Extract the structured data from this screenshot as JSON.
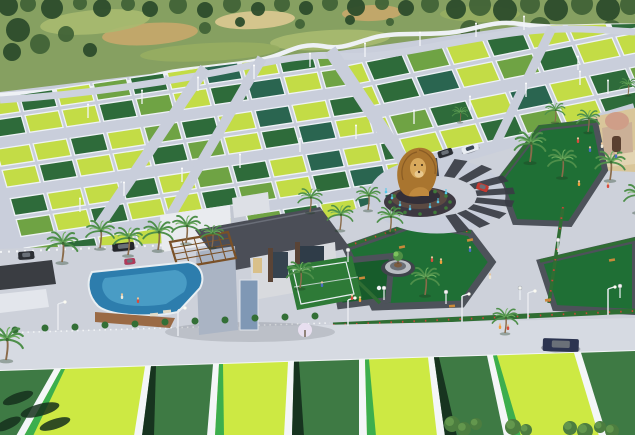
{
  "scene": {
    "description": "3D aerial render of a plotted real-estate township with green plots, internal roads, lion-statue roundabout, landscaped park, clubhouse with pool and court",
    "width": 635,
    "height": 435
  },
  "palette": {
    "natureBase": "#86a061",
    "fieldLight": "#a8ba70",
    "fieldMid": "#97ad62",
    "dirt": "#c8a76b",
    "dirtLight": "#ddc992",
    "treeDark": "#2c4c2b",
    "treeMid": "#416337",
    "wall": "#eef1f5",
    "road": "#c9cedb",
    "roadTop": "#d2d6e0",
    "roadBottom": "#d6dae2",
    "concrete": "#cdd1da",
    "fence": "#eef2f6",
    "limePlot": "#c3dc46",
    "midPlot": "#6fa344",
    "darkPlot": "#2e6b3a",
    "tealPlot": "#2a6550",
    "fgLime": "#cde943",
    "fgDark": "#3e7a44",
    "stripeGreen": "#3cae4e",
    "stripeShadow": "#17341f",
    "parkLawn": "#1f6f35",
    "parkLawnDark": "#175c2b",
    "pathGray": "#4d525a",
    "hedge": "#2f6d33",
    "flower": "#cf4238",
    "palmTrunk": "#8a6b4a",
    "palmFrond": "#4e8f4a",
    "lionGold": "#a9752f",
    "lionFace": "#d8a95c",
    "lionChest": "#c08a3e",
    "statueBase": "#332f38",
    "statueTier": "#5b4a42",
    "fountain": "#54c8e8",
    "stripeDark": "#383c44",
    "poolBlue": "#2d7dad",
    "poolLight": "#53a7cd",
    "roofDark": "#4b4e57",
    "buildingWhite": "#e9ebef",
    "buildingShade": "#c2c7d1",
    "buildingBlue": "#aab4c4",
    "pergola": "#7a5128",
    "courtGreen": "#2e7a37",
    "sand": "#d9c69a",
    "templeBeige": "#cbb097",
    "templeDome": "#cf9e88",
    "shedDark": "#3a3d42",
    "tentWhite": "#e3e6ec",
    "benchWood": "#c9893a",
    "white": "#f4f6f8"
  },
  "background": {
    "patches": [
      {
        "x": 150,
        "y": 34,
        "rx": 48,
        "ry": 11,
        "c": "dirt",
        "rot": -4
      },
      {
        "x": 255,
        "y": 20,
        "rx": 40,
        "ry": 9,
        "c": "dirtLight",
        "rot": -3
      },
      {
        "x": 372,
        "y": 13,
        "rx": 30,
        "ry": 8,
        "c": "dirt",
        "rot": -2
      },
      {
        "x": 95,
        "y": 22,
        "rx": 55,
        "ry": 12,
        "c": "fieldLight",
        "rot": -5
      },
      {
        "x": 330,
        "y": 40,
        "rx": 60,
        "ry": 10,
        "c": "fieldLight",
        "rot": -3
      },
      {
        "x": 480,
        "y": 14,
        "rx": 40,
        "ry": 8,
        "c": "fieldMid",
        "rot": 0
      },
      {
        "x": 210,
        "y": 52,
        "rx": 70,
        "ry": 9,
        "c": "fieldMid",
        "rot": -3
      }
    ],
    "trees": [
      [
        8,
        6,
        10
      ],
      [
        28,
        4,
        8
      ],
      [
        52,
        8,
        11
      ],
      [
        80,
        3,
        7
      ],
      [
        102,
        8,
        9
      ],
      [
        128,
        4,
        7
      ],
      [
        150,
        9,
        8
      ],
      [
        178,
        5,
        9
      ],
      [
        205,
        10,
        8
      ],
      [
        232,
        4,
        9
      ],
      [
        258,
        9,
        7
      ],
      [
        282,
        4,
        8
      ],
      [
        306,
        8,
        7
      ],
      [
        330,
        3,
        8
      ],
      [
        356,
        7,
        9
      ],
      [
        382,
        3,
        7
      ],
      [
        406,
        8,
        8
      ],
      [
        430,
        4,
        9
      ],
      [
        456,
        9,
        10
      ],
      [
        480,
        5,
        11
      ],
      [
        505,
        10,
        12
      ],
      [
        530,
        4,
        10
      ],
      [
        556,
        9,
        12
      ],
      [
        582,
        4,
        11
      ],
      [
        608,
        9,
        12
      ],
      [
        630,
        5,
        10
      ],
      [
        18,
        30,
        12
      ],
      [
        40,
        44,
        10
      ],
      [
        12,
        52,
        9
      ],
      [
        66,
        34,
        8
      ],
      [
        90,
        50,
        7
      ],
      [
        470,
        30,
        10
      ],
      [
        500,
        40,
        9
      ],
      [
        540,
        28,
        11
      ],
      [
        575,
        40,
        8
      ],
      [
        612,
        30,
        10
      ],
      [
        628,
        48,
        9
      ],
      [
        205,
        28,
        6
      ],
      [
        240,
        22,
        5
      ],
      [
        300,
        24,
        5
      ],
      [
        350,
        20,
        5
      ],
      [
        390,
        22,
        4
      ]
    ]
  },
  "plot_colors": {
    "cycle": [
      "limePlot",
      "darkPlot",
      "limePlot",
      "midPlot",
      "darkPlot",
      "limePlot",
      "tealPlot",
      "limePlot",
      "darkPlot",
      "midPlot",
      "limePlot",
      "darkPlot",
      "limePlot",
      "limePlot",
      "darkPlot",
      "midPlot",
      "limePlot",
      "darkPlot",
      "tealPlot",
      "limePlot",
      "midPlot",
      "darkPlot",
      "limePlot"
    ]
  },
  "plot_zones": [
    {
      "id": "zoneA-plots",
      "origin": [
        -18,
        100
      ],
      "col": [
        37,
        -5.5
      ],
      "row": [
        6,
        21
      ],
      "cols": 11,
      "rows": 8,
      "fw": 0.9,
      "fh": 0.8,
      "offset": 0
    },
    {
      "id": "zoneB-plots",
      "origin": [
        326,
        70
      ],
      "col": [
        40,
        -8
      ],
      "row": [
        10,
        23
      ],
      "cols": 9,
      "rows": 7,
      "fw": 0.9,
      "fh": 0.8,
      "offset": 7
    }
  ],
  "foreground": {
    "top_y0": 371,
    "top_slope": -0.0315,
    "plots": [
      {
        "t1": -15,
        "t2": 54,
        "b1": -48,
        "b2": 16,
        "c": "fgDark",
        "s": null
      },
      {
        "t1": 61,
        "t2": 145,
        "b1": 24,
        "b2": 134,
        "c": "fgLime",
        "s": "green"
      },
      {
        "t1": 151,
        "t2": 213,
        "b1": 142,
        "b2": 207,
        "c": "fgDark",
        "s": "shadow"
      },
      {
        "t1": 219,
        "t2": 288,
        "b1": 215,
        "b2": 284,
        "c": "fgLime",
        "s": "green"
      },
      {
        "t1": 294,
        "t2": 359,
        "b1": 292,
        "b2": 359,
        "c": "fgDark",
        "s": "shadow"
      },
      {
        "t1": 365,
        "t2": 428,
        "b1": 367,
        "b2": 437,
        "c": "fgLime",
        "s": "green"
      },
      {
        "t1": 434,
        "t2": 487,
        "b1": 445,
        "b2": 504,
        "c": "fgDark",
        "s": "shadow"
      },
      {
        "t1": 493,
        "t2": 574,
        "b1": 512,
        "b2": 599,
        "c": "fgLime",
        "s": "green"
      },
      {
        "t1": 581,
        "t2": 680,
        "b1": 607,
        "b2": 700,
        "c": "fgDark",
        "s": null
      }
    ],
    "shadows": [
      [
        18,
        398,
        16,
        5,
        -20
      ],
      [
        40,
        410,
        20,
        6,
        -15
      ],
      [
        8,
        424,
        14,
        5,
        -25
      ],
      [
        55,
        424,
        16,
        5,
        -18
      ]
    ],
    "trees": [
      [
        452,
        424,
        8
      ],
      [
        464,
        429,
        7
      ],
      [
        476,
        424,
        6
      ],
      [
        513,
        427,
        8
      ],
      [
        526,
        430,
        6
      ],
      [
        570,
        428,
        7
      ],
      [
        585,
        431,
        8
      ],
      [
        600,
        427,
        6
      ],
      [
        612,
        431,
        7
      ]
    ]
  },
  "roundabout": {
    "cx": 437,
    "cy": 196,
    "inner": [
      40,
      20
    ],
    "outer": [
      78,
      38
    ],
    "stripe_angles": [
      95,
      72,
      50,
      28,
      8,
      -12,
      -32,
      -52,
      -70
    ]
  },
  "fountain_jets": [
    [
      392,
      198
    ],
    [
      400,
      205
    ],
    [
      438,
      202
    ],
    [
      430,
      207
    ],
    [
      410,
      209
    ],
    [
      446,
      193
    ],
    [
      386,
      192
    ]
  ],
  "palms": [
    [
      100,
      248,
      1
    ],
    [
      128,
      255,
      1
    ],
    [
      158,
      250,
      1.05
    ],
    [
      186,
      243,
      1
    ],
    [
      62,
      262,
      1.1
    ],
    [
      212,
      247,
      0.8
    ],
    [
      310,
      212,
      0.85
    ],
    [
      340,
      230,
      0.9
    ],
    [
      368,
      210,
      0.85
    ],
    [
      390,
      232,
      0.9
    ],
    [
      425,
      295,
      1
    ],
    [
      300,
      288,
      0.95
    ],
    [
      530,
      162,
      1.1
    ],
    [
      562,
      177,
      1
    ],
    [
      610,
      180,
      1.05
    ],
    [
      588,
      132,
      0.8
    ],
    [
      555,
      122,
      0.7
    ],
    [
      638,
      212,
      1
    ],
    [
      505,
      333,
      0.9
    ],
    [
      6,
      360,
      1.2
    ],
    [
      628,
      95,
      0.6
    ],
    [
      460,
      122,
      0.55
    ]
  ],
  "plot_poles": [
    [
      88,
      118
    ],
    [
      142,
      104
    ],
    [
      198,
      91
    ],
    [
      254,
      79
    ],
    [
      310,
      67
    ],
    [
      365,
      57
    ],
    [
      420,
      46
    ],
    [
      476,
      37
    ],
    [
      300,
      152
    ],
    [
      356,
      139
    ],
    [
      414,
      124
    ],
    [
      470,
      110
    ],
    [
      526,
      97
    ],
    [
      580,
      85
    ],
    [
      240,
      168
    ],
    [
      182,
      182
    ],
    [
      124,
      196
    ],
    [
      80,
      212
    ],
    [
      524,
      30
    ],
    [
      578,
      70
    ],
    [
      608,
      94
    ],
    [
      555,
      140
    ]
  ],
  "road_lamps": [
    [
      58,
      330
    ],
    [
      178,
      336
    ],
    [
      348,
      326
    ],
    [
      462,
      322
    ],
    [
      528,
      319
    ],
    [
      608,
      315
    ]
  ],
  "park_lamps": [
    [
      348,
      262
    ],
    [
      384,
      300
    ],
    [
      446,
      304
    ],
    [
      520,
      300
    ],
    [
      558,
      252
    ],
    [
      620,
      298
    ]
  ],
  "benches": [
    [
      362,
      278,
      -10
    ],
    [
      402,
      247,
      -12
    ],
    [
      452,
      306,
      -5
    ],
    [
      548,
      300,
      -8
    ],
    [
      612,
      260,
      -10
    ],
    [
      470,
      240,
      -12
    ]
  ],
  "bushes": [
    [
      15,
      330
    ],
    [
      45,
      328
    ],
    [
      75,
      327
    ],
    [
      105,
      325
    ],
    [
      135,
      324
    ],
    [
      165,
      322
    ],
    [
      195,
      321
    ],
    [
      225,
      320
    ],
    [
      255,
      318
    ],
    [
      285,
      317
    ],
    [
      315,
      316
    ]
  ],
  "people": [
    [
      578,
      143,
      0
    ],
    [
      590,
      152,
      1
    ],
    [
      602,
      148,
      2
    ],
    [
      579,
      186,
      3
    ],
    [
      608,
      188,
      0
    ],
    [
      616,
      158,
      1
    ],
    [
      432,
      262,
      0
    ],
    [
      441,
      264,
      3
    ],
    [
      490,
      279,
      2
    ],
    [
      470,
      252,
      1
    ],
    [
      352,
      300,
      0
    ],
    [
      360,
      302,
      3
    ],
    [
      122,
      299,
      2
    ],
    [
      138,
      303,
      0
    ],
    [
      322,
      287,
      1
    ],
    [
      500,
      329,
      3
    ],
    [
      508,
      330,
      0
    ]
  ],
  "people_colors": [
    "#d84c3e",
    "#4a6fc4",
    "#f2ead8",
    "#f0a03c"
  ],
  "cars": [
    {
      "x": 18,
      "y": 252,
      "w": 16,
      "h": 8,
      "c": "#2b2e33",
      "r": -4
    },
    {
      "x": 112,
      "y": 244,
      "w": 22,
      "h": 8,
      "c": "#24262b",
      "r": -6
    },
    {
      "x": 124,
      "y": 259,
      "w": 11,
      "h": 6,
      "c": "#b03a5a",
      "r": -6
    },
    {
      "x": 437,
      "y": 152,
      "w": 15,
      "h": 7,
      "c": "#2a2d33",
      "r": -18
    },
    {
      "x": 461,
      "y": 148,
      "w": 17,
      "h": 7,
      "c": "#e8ecf2",
      "r": -18
    },
    {
      "x": 478,
      "y": 182,
      "w": 12,
      "h": 7,
      "c": "#c23a32",
      "r": 20
    },
    {
      "x": 543,
      "y": 338,
      "w": 36,
      "h": 13,
      "c": "#2c3450",
      "r": 2
    }
  ]
}
